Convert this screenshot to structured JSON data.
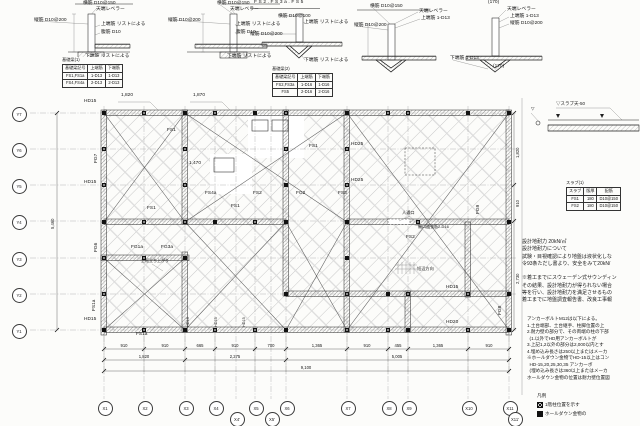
{
  "tables": {
    "beam1": {
      "title": "基礎梁(1)",
      "headers": [
        "基礎梁記号",
        "上端筋",
        "下端筋"
      ],
      "rows": [
        [
          "FS1,FS1a",
          "1-D13",
          "1-D13"
        ],
        [
          "FS4,FS4a",
          "2-D13",
          "2-D13"
        ]
      ]
    },
    "beam2": {
      "title": "基礎梁(2)",
      "headers": [
        "基礎梁記号",
        "上端筋",
        "下端筋"
      ],
      "rows": [
        [
          "FS2,FS3a",
          "1-D16",
          "1-D16"
        ],
        [
          "FS5",
          "2-D16",
          "2-D16"
        ]
      ]
    },
    "slab": {
      "title": "スラブ(1)",
      "headers": [
        "スラブ",
        "版厚",
        "配筋"
      ],
      "rows": [
        [
          "FS1",
          "180",
          "D10@150"
        ],
        [
          "FS2",
          "180",
          "D10@150"
        ]
      ]
    }
  },
  "notes_soil": [
    "設計地耐力 20kN/㎡",
    "設計地耐力について",
    "試験・目視確認により地盤は液状化しな",
    "令93条ただし書より、安全をみて20kN/",
    "",
    "※着工までにスウェーデン式サウンディン",
    "その結果、設計地耐力が得られない場合",
    "等を行い、設計地耐力を満足させるもの",
    "着工までに地盤調査報告書、改良工事報"
  ],
  "notes_anchor": [
    "アンカーボルトM12は以下による。",
    "1.土台端部、土台継手、柱脚位置の上",
    "2.耐力壁の部分で、その両端の柱の下部",
    "  (1.以外でHD用アンカーボルトが",
    "3.上記1,2以外の部分は2,000以内とす",
    "4.埋め込み長さは250以上またはメーカ",
    "※ホールダウン金物でHD-15以上はコン",
    "  HD-15,20,25,30,35 アンカーボ",
    "  (埋め込み長さは360以上またはメーカ",
    "ホールダウン金物の位置は耐力壁位置図"
  ],
  "legend": {
    "title": "凡例",
    "items": [
      {
        "sym": "x",
        "label": "1階柱位置を示す"
      },
      {
        "sym": "f",
        "label": "ホールダウン金物の"
      }
    ]
  },
  "plan": {
    "vlines": [
      104,
      144,
      185,
      215,
      236,
      255,
      271,
      286,
      347,
      388,
      408,
      468,
      509
    ],
    "hlines": [
      113,
      149,
      185,
      221,
      258,
      294,
      330
    ],
    "bubbles": [
      {
        "l": "X1",
        "x": 104,
        "y": 407
      },
      {
        "l": "X2",
        "x": 144,
        "y": 407
      },
      {
        "l": "X3",
        "x": 185,
        "y": 407
      },
      {
        "l": "X4",
        "x": 215,
        "y": 407
      },
      {
        "l": "X5",
        "x": 255,
        "y": 407
      },
      {
        "l": "X6",
        "x": 286,
        "y": 407
      },
      {
        "l": "X7",
        "x": 347,
        "y": 407
      },
      {
        "l": "X8",
        "x": 388,
        "y": 407
      },
      {
        "l": "X9",
        "x": 408,
        "y": 407
      },
      {
        "l": "X10",
        "x": 468,
        "y": 407
      },
      {
        "l": "X11",
        "x": 509,
        "y": 407
      },
      {
        "l": "X4'",
        "x": 236,
        "y": 418
      },
      {
        "l": "X5'",
        "x": 271,
        "y": 418
      },
      {
        "l": "X11'",
        "x": 514,
        "y": 418
      },
      {
        "l": "Y7",
        "x": 18,
        "y": 113
      },
      {
        "l": "Y6",
        "x": 18,
        "y": 149
      },
      {
        "l": "Y5",
        "x": 18,
        "y": 185
      },
      {
        "l": "Y4",
        "x": 18,
        "y": 221
      },
      {
        "l": "Y3",
        "x": 18,
        "y": 258
      },
      {
        "l": "Y2",
        "x": 18,
        "y": 294
      },
      {
        "l": "Y1",
        "x": 18,
        "y": 330
      }
    ],
    "dim_bounds1": [
      104,
      144,
      185,
      215,
      255,
      286,
      347,
      388,
      408,
      468,
      509
    ],
    "dim_bounds2": [
      104,
      185,
      286,
      509
    ],
    "dim_bounds3": [
      104,
      509
    ],
    "braces": [
      [
        104,
        113,
        185,
        222
      ],
      [
        185,
        113,
        347,
        222
      ],
      [
        104,
        258,
        185,
        330
      ],
      [
        185,
        222,
        286,
        330
      ],
      [
        286,
        222,
        347,
        330
      ],
      [
        347,
        113,
        509,
        330
      ]
    ],
    "squares": [
      [
        104,
        113,
        "f"
      ],
      [
        144,
        113,
        "x"
      ],
      [
        185,
        113,
        "f"
      ],
      [
        215,
        113,
        "x"
      ],
      [
        255,
        113,
        "f"
      ],
      [
        286,
        113,
        "x"
      ],
      [
        347,
        113,
        "f"
      ],
      [
        388,
        113,
        "x"
      ],
      [
        408,
        113,
        "x"
      ],
      [
        468,
        113,
        "f"
      ],
      [
        509,
        113,
        "f"
      ],
      [
        104,
        149,
        "x"
      ],
      [
        185,
        149,
        "x"
      ],
      [
        286,
        149,
        "x"
      ],
      [
        347,
        149,
        "x"
      ],
      [
        104,
        185,
        "x"
      ],
      [
        185,
        185,
        "x"
      ],
      [
        286,
        185,
        "f"
      ],
      [
        347,
        185,
        "x"
      ],
      [
        104,
        222,
        "f"
      ],
      [
        144,
        222,
        "x"
      ],
      [
        185,
        222,
        "x"
      ],
      [
        215,
        222,
        "f"
      ],
      [
        255,
        222,
        "x"
      ],
      [
        286,
        222,
        "f"
      ],
      [
        347,
        222,
        "f"
      ],
      [
        418,
        222,
        "x"
      ],
      [
        509,
        222,
        "f"
      ],
      [
        104,
        258,
        "x"
      ],
      [
        144,
        258,
        "x"
      ],
      [
        185,
        258,
        "f"
      ],
      [
        347,
        258,
        "f"
      ],
      [
        104,
        294,
        "x"
      ],
      [
        286,
        294,
        "f"
      ],
      [
        347,
        294,
        "x"
      ],
      [
        388,
        294,
        "f"
      ],
      [
        408,
        294,
        "x"
      ],
      [
        468,
        294,
        "x"
      ],
      [
        509,
        294,
        "f"
      ],
      [
        104,
        330,
        "f"
      ],
      [
        144,
        330,
        "x"
      ],
      [
        185,
        330,
        "f"
      ],
      [
        215,
        330,
        "x"
      ],
      [
        255,
        330,
        "x"
      ],
      [
        286,
        330,
        "f"
      ],
      [
        347,
        330,
        "x"
      ],
      [
        388,
        330,
        "x"
      ],
      [
        408,
        330,
        "f"
      ],
      [
        468,
        330,
        "x"
      ],
      [
        509,
        330,
        "f"
      ]
    ]
  },
  "annotations": [
    {
      "t": "横筋 D10@150",
      "x": 83,
      "y": 2
    },
    {
      "t": "天端レベラー",
      "x": 96,
      "y": 8
    },
    {
      "t": "縦筋 D10@200",
      "x": 34,
      "y": 19
    },
    {
      "t": "上端筋 リストによる",
      "x": 101,
      "y": 23
    },
    {
      "t": "腹筋 D10",
      "x": 101,
      "y": 31
    },
    {
      "t": "下端筋 リストによる",
      "x": 85,
      "y": 55
    },
    {
      "t": "横筋 D10@150",
      "x": 217,
      "y": 2
    },
    {
      "t": "天端レベラー",
      "x": 230,
      "y": 8
    },
    {
      "t": "縦筋 D10@200",
      "x": 168,
      "y": 19
    },
    {
      "t": "上端筋 リストによる",
      "x": 236,
      "y": 23
    },
    {
      "t": "腹筋 D10",
      "x": 236,
      "y": 31
    },
    {
      "t": "下端筋 リストによる",
      "x": 227,
      "y": 55
    },
    {
      "t": "FS2.FS3a.FS5",
      "x": 254,
      "y": 1,
      "ls": 1.6
    },
    {
      "t": "横筋 D10@100",
      "x": 278,
      "y": 15
    },
    {
      "t": "上端筋 リストによる",
      "x": 304,
      "y": 21
    },
    {
      "t": "縦筋 D10@200",
      "x": 250,
      "y": 33
    },
    {
      "t": "下端筋 リストによる",
      "x": 304,
      "y": 59
    },
    {
      "t": "横筋 D10@150",
      "x": 370,
      "y": 5
    },
    {
      "t": "天端レベラー",
      "x": 419,
      "y": 10
    },
    {
      "t": "上端筋 1-D13",
      "x": 421,
      "y": 17
    },
    {
      "t": "縦筋 D10@200",
      "x": 354,
      "y": 24
    },
    {
      "t": "天端レベラー",
      "x": 507,
      "y": 8
    },
    {
      "t": "上端筋 1-D13",
      "x": 510,
      "y": 15
    },
    {
      "t": "縦筋 D10@200",
      "x": 510,
      "y": 22
    },
    {
      "t": "下端筋 1-D13",
      "x": 450,
      "y": 57
    },
    {
      "t": "(170)",
      "x": 488,
      "y": 1
    },
    {
      "t": "(170)",
      "x": 493,
      "y": 65
    },
    {
      "t": "1,820",
      "x": 121,
      "y": 94
    },
    {
      "t": "1,870",
      "x": 193,
      "y": 94
    },
    {
      "t": "HD15",
      "x": 84,
      "y": 100
    },
    {
      "t": "FG7",
      "x": 95,
      "y": 163,
      "r": 1
    },
    {
      "t": "FG6",
      "x": 95,
      "y": 252,
      "r": 1
    },
    {
      "t": "HD15",
      "x": 84,
      "y": 181
    },
    {
      "t": "HD15",
      "x": 84,
      "y": 318
    },
    {
      "t": "FS1",
      "x": 167,
      "y": 129
    },
    {
      "t": "FS1",
      "x": 147,
      "y": 207
    },
    {
      "t": "1,470",
      "x": 189,
      "y": 162
    },
    {
      "t": "FS4a",
      "x": 205,
      "y": 192
    },
    {
      "t": "FS2",
      "x": 253,
      "y": 192
    },
    {
      "t": "FS1",
      "x": 231,
      "y": 205
    },
    {
      "t": "FG1a",
      "x": 131,
      "y": 246
    },
    {
      "t": "FG3a",
      "x": 161,
      "y": 246
    },
    {
      "t": "上框立ち上がり",
      "x": 141,
      "y": 259,
      "s": 4
    },
    {
      "t": "FS1a",
      "x": 136,
      "y": 333
    },
    {
      "t": "FS1a",
      "x": 93,
      "y": 311,
      "r": 1
    },
    {
      "t": "FS1",
      "x": 309,
      "y": 145
    },
    {
      "t": "FG2",
      "x": 296,
      "y": 192
    },
    {
      "t": "FS3",
      "x": 338,
      "y": 192
    },
    {
      "t": "HD25",
      "x": 351,
      "y": 143
    },
    {
      "t": "HD25",
      "x": 351,
      "y": 179
    },
    {
      "t": "FS2",
      "x": 406,
      "y": 236
    },
    {
      "t": "人通口",
      "x": 402,
      "y": 211,
      "s": 4.2
    },
    {
      "t": "開口補強筋2-D16",
      "x": 418,
      "y": 225,
      "s": 4
    },
    {
      "t": "短辺方向",
      "x": 417,
      "y": 267,
      "s": 4.2
    },
    {
      "t": "FG9",
      "x": 477,
      "y": 214,
      "r": 1
    },
    {
      "t": "FG8",
      "x": 499,
      "y": 315,
      "r": 1
    },
    {
      "t": "HD15",
      "x": 446,
      "y": 286
    },
    {
      "t": "HD20",
      "x": 446,
      "y": 321
    },
    {
      "t": "HD15",
      "x": 187,
      "y": 327,
      "r": 1,
      "s": 3.8
    },
    {
      "t": "HD15",
      "x": 215,
      "y": 327,
      "r": 1,
      "s": 3.8
    },
    {
      "t": "HD15",
      "x": 243,
      "y": 327,
      "r": 1,
      "s": 3.8
    },
    {
      "t": "910",
      "x": 124,
      "y": 344,
      "c": 1,
      "s": 4.2
    },
    {
      "t": "910",
      "x": 165,
      "y": 344,
      "c": 1,
      "s": 4.2
    },
    {
      "t": "665",
      "x": 200,
      "y": 344,
      "c": 1,
      "s": 4.2
    },
    {
      "t": "910",
      "x": 235,
      "y": 344,
      "c": 1,
      "s": 4.2
    },
    {
      "t": "700",
      "x": 271,
      "y": 344,
      "c": 1,
      "s": 4.2
    },
    {
      "t": "1,365",
      "x": 317,
      "y": 344,
      "c": 1,
      "s": 4.2
    },
    {
      "t": "910",
      "x": 367,
      "y": 344,
      "c": 1,
      "s": 4.2
    },
    {
      "t": "455",
      "x": 398,
      "y": 344,
      "c": 1,
      "s": 4.2
    },
    {
      "t": "1,365",
      "x": 438,
      "y": 344,
      "c": 1,
      "s": 4.2
    },
    {
      "t": "910",
      "x": 489,
      "y": 344,
      "c": 1,
      "s": 4.2
    },
    {
      "t": "1,820",
      "x": 144,
      "y": 355,
      "c": 1,
      "s": 4.2
    },
    {
      "t": "2,275",
      "x": 235,
      "y": 355,
      "c": 1,
      "s": 4.2
    },
    {
      "t": "5,005",
      "x": 397,
      "y": 355,
      "c": 1,
      "s": 4.2
    },
    {
      "t": "9,100",
      "x": 306,
      "y": 366,
      "c": 1,
      "s": 4.2
    },
    {
      "t": "5,460",
      "x": 51,
      "y": 229,
      "r": 1,
      "s": 4.2
    },
    {
      "t": "1,820",
      "x": 516,
      "y": 158,
      "r": 1,
      "s": 4.2
    },
    {
      "t": "910",
      "x": 516,
      "y": 207,
      "r": 1,
      "s": 4.2
    },
    {
      "t": "2,730",
      "x": 516,
      "y": 284,
      "r": 1,
      "s": 4.2
    },
    {
      "t": "▽スラブ天-50",
      "x": 556,
      "y": 102,
      "s": 4.5
    },
    {
      "t": "▽",
      "x": 531,
      "y": 107,
      "s": 4.5
    }
  ]
}
